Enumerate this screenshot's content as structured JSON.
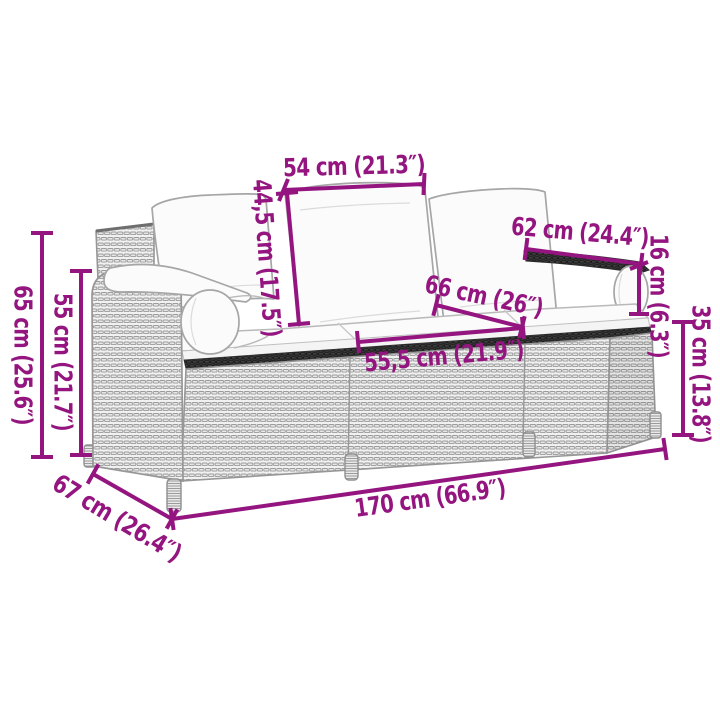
{
  "diagram": {
    "kind": "furniture-dimension-diagram",
    "subject": "rattan-garden-sofa-with-cushions",
    "colors": {
      "dimension_accent": "#94157F",
      "sofa_outline": "#979797",
      "weave_fill": "#F1F1F1",
      "weave_dark_band": "#3E3E3E",
      "cushion_fill": "#FBFBFB",
      "background": "#FFFFFF"
    },
    "dims": {
      "d54": {
        "name": "back-cushion-width",
        "label": "54 cm (21.3″)"
      },
      "d445": {
        "name": "back-cushion-height",
        "label": "44,5 cm (17.5″)"
      },
      "d62": {
        "name": "armrest-length",
        "label": "62 cm (24.4″)"
      },
      "d16": {
        "name": "armrest-drop-height",
        "label": "16 cm (6.3″)"
      },
      "d66": {
        "name": "seat-depth",
        "label": "66 cm (26″)"
      },
      "d555": {
        "name": "seat-cushion-width",
        "label": "55,5 cm (21.9″)"
      },
      "d65": {
        "name": "total-height",
        "label": "65 cm (25.6″)"
      },
      "d55": {
        "name": "armrest-height",
        "label": "55 cm (21.7″)"
      },
      "d35": {
        "name": "seat-height",
        "label": "35 cm (13.8″)"
      },
      "d67": {
        "name": "total-depth",
        "label": "67 cm (26.4″)"
      },
      "d170": {
        "name": "total-width",
        "label": "170 cm (66.9″)"
      }
    }
  }
}
